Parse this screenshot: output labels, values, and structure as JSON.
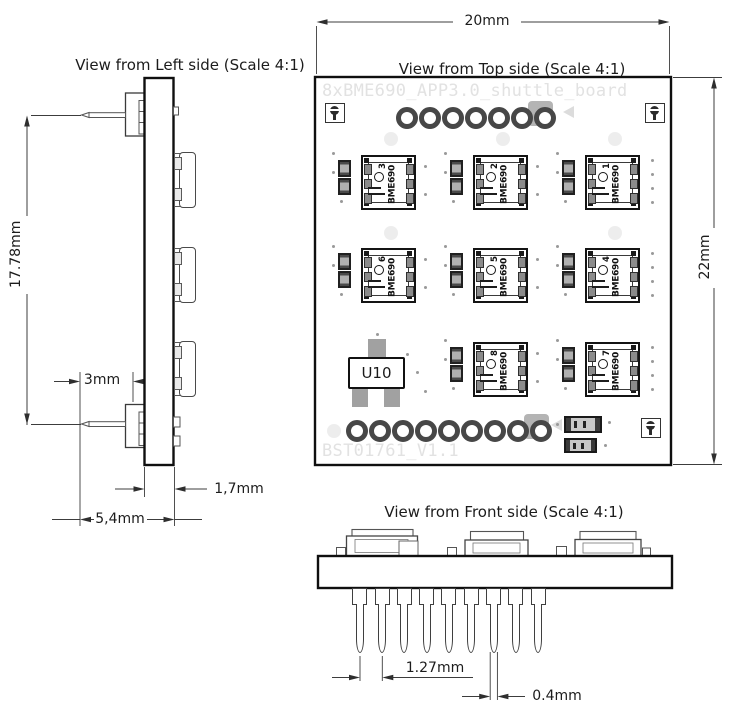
{
  "views": {
    "left": {
      "title": "View from Left side (Scale 4:1)"
    },
    "top": {
      "title": "View from Top side (Scale 4:1)"
    },
    "front": {
      "title": "View from Front side (Scale 4:1)"
    }
  },
  "dimensions": {
    "board_width": "20mm",
    "board_height": "22mm",
    "pin_row_span": "17.78mm",
    "pin_protrusion": "3mm",
    "board_thickness": "1,7mm",
    "side_depth_total": "5,4mm",
    "pin_pitch": "1.27mm",
    "pin_width": "0.4mm"
  },
  "silkscreen": {
    "top_label": "8xBME690_APP3.0_shuttle_board",
    "bottom_label": "BST01761_V1.1"
  },
  "components": {
    "u10_label": "U10",
    "sensor_chip_text": "BME690",
    "sensor_numbers": [
      "3",
      "2",
      "1",
      "6",
      "5",
      "4",
      "8",
      "7"
    ]
  },
  "board_features": {
    "top_hole_count": 7,
    "bottom_hole_count": 9,
    "header_pin_count": 9,
    "sensor_count": 8
  },
  "colors": {
    "line": "#2e2e2e",
    "board_outline": "#111111",
    "silkscreen_text": "#e2e2e2",
    "pad_gray": "#b4b4b4",
    "component_gray": "#9a9a9a"
  }
}
